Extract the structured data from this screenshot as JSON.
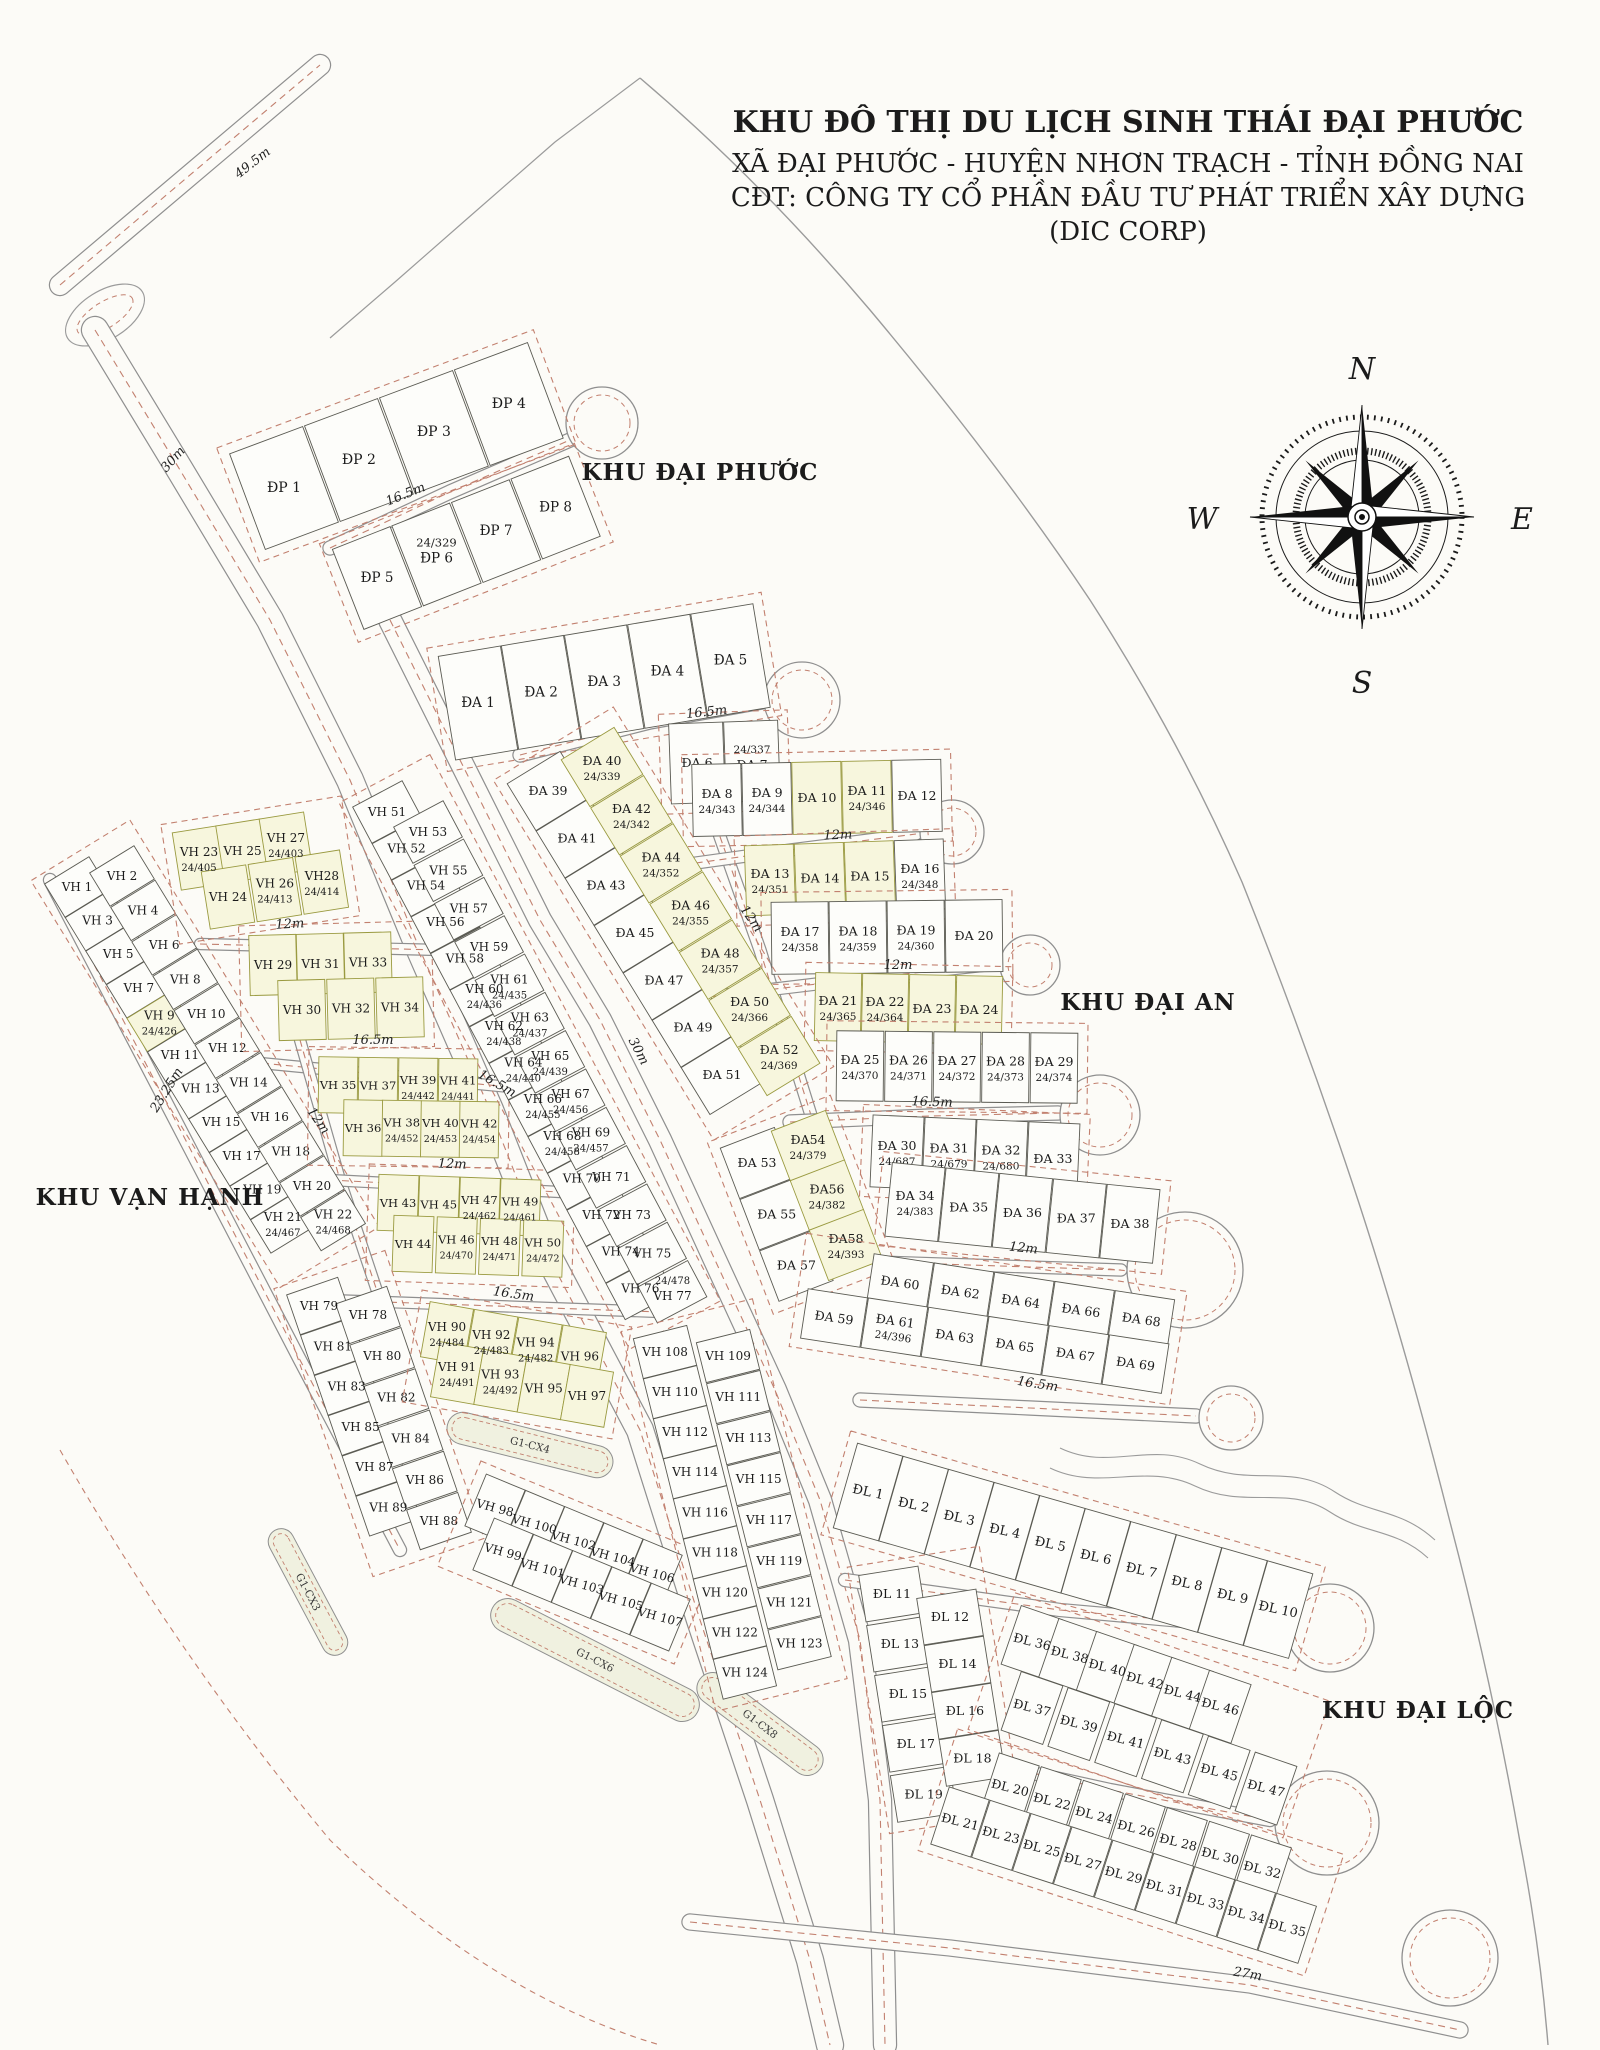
{
  "title": {
    "line1": "KHU ĐÔ THỊ DU LỊCH SINH THÁI ĐẠI PHƯỚC",
    "line2": "XÃ ĐẠI PHƯỚC - HUYỆN NHƠN TRẠCH - TỈNH ĐỒNG NAI",
    "line3": "CĐT: CÔNG TY CỔ PHẦN ĐẦU TƯ PHÁT TRIỂN XÂY DỰNG",
    "line4": "(DIC CORP)"
  },
  "compass": {
    "n": "N",
    "e": "E",
    "s": "S",
    "w": "W"
  },
  "areas": [
    {
      "label": "KHU ĐẠI PHƯỚC"
    },
    {
      "label": "KHU ĐẠI AN"
    },
    {
      "label": "KHU VẠN HẠNH"
    },
    {
      "label": "KHU ĐẠI LỘC"
    }
  ],
  "dimensions": [
    "49.5m",
    "30m",
    "16.5m",
    "16.5m",
    "12m",
    "12m",
    "12m",
    "16.5m",
    "12m",
    "16.5m",
    "12m",
    "16.5m",
    "12m",
    "12m",
    "16.5m",
    "23.25m",
    "30m",
    "16.5m",
    "27m"
  ],
  "greens": [
    "G1-CX3",
    "G1-CX4",
    "G1-CX6",
    "G1-CX8"
  ],
  "colors": {
    "road_dash": "#c2806f",
    "road_edge": "#8f8f8f",
    "lot_fill": "#fdfdfa",
    "lot_tint": "#f7f6dd",
    "paper": "#fcfbf7"
  },
  "blocks": {
    "dp1": {
      "rows": [
        [
          "ĐP 1",
          "ĐP 2",
          "ĐP 3",
          "ĐP 4"
        ]
      ]
    },
    "dp2": {
      "rows": [
        [
          "ĐP 5",
          {
            "n": "ĐP 6",
            "s": "24/329",
            "sa": 1
          },
          "ĐP 7",
          "ĐP 8"
        ]
      ]
    },
    "da1_5": {
      "rows": [
        [
          "ĐA 1",
          "ĐA 2",
          "ĐA 3",
          "ĐA 4",
          "ĐA 5"
        ]
      ]
    },
    "da6_7": {
      "rows": [
        [
          "ĐA 6",
          {
            "n": "ĐA 7",
            "s": "24/337",
            "sa": 1
          }
        ]
      ]
    },
    "da8_12": {
      "rows": [
        [
          {
            "n": "ĐA 8",
            "s": "24/343"
          },
          {
            "n": "ĐA 9",
            "s": "24/344"
          },
          {
            "n": "ĐA 10",
            "t": 1
          },
          {
            "n": "ĐA 11",
            "s": "24/346",
            "t": 1
          },
          "ĐA 12"
        ]
      ]
    },
    "da13_16": {
      "rows": [
        [
          {
            "n": "ĐA 13",
            "s": "24/351",
            "t": 1
          },
          {
            "n": "ĐA 14",
            "t": 1
          },
          {
            "n": "ĐA 15",
            "t": 1
          },
          {
            "n": "ĐA 16",
            "s": "24/348"
          }
        ]
      ]
    },
    "da17_20": {
      "rows": [
        [
          {
            "n": "ĐA 17",
            "s": "24/358"
          },
          {
            "n": "ĐA 18",
            "s": "24/359"
          },
          {
            "n": "ĐA 19",
            "s": "24/360"
          },
          "ĐA 20"
        ]
      ]
    },
    "da21_24": {
      "rows": [
        [
          {
            "n": "ĐA 21",
            "s": "24/365",
            "t": 1
          },
          {
            "n": "ĐA 22",
            "s": "24/364",
            "t": 1
          },
          {
            "n": "ĐA 23",
            "t": 1
          },
          {
            "n": "ĐA 24",
            "t": 1
          }
        ]
      ]
    },
    "da25_29": {
      "rows": [
        [
          {
            "n": "ĐA 25",
            "s": "24/370"
          },
          {
            "n": "ĐA 26",
            "s": "24/371"
          },
          {
            "n": "ĐA 27",
            "s": "24/372"
          },
          {
            "n": "ĐA 28",
            "s": "24/373"
          },
          {
            "n": "ĐA 29",
            "s": "24/374"
          }
        ]
      ]
    },
    "da30_33": {
      "rows": [
        [
          {
            "n": "ĐA 30",
            "s": "24/687"
          },
          {
            "n": "ĐA 31",
            "s": "24/679"
          },
          {
            "n": "ĐA 32",
            "s": "24/680"
          },
          "ĐA 33"
        ]
      ]
    },
    "da34_38": {
      "rows": [
        [
          {
            "n": "ĐA 34",
            "s": "24/383"
          },
          "ĐA 35",
          "ĐA 36",
          "ĐA 37",
          "ĐA 38"
        ]
      ]
    },
    "da39_52": {
      "rows": [
        [
          "ĐA 39",
          "ĐA 41",
          "ĐA 43",
          "ĐA 45",
          "ĐA 47",
          "ĐA 49",
          "ĐA 51"
        ],
        [
          {
            "n": "ĐA 40",
            "s": "24/339",
            "t": 1
          },
          {
            "n": "ĐA 42",
            "s": "24/342",
            "t": 1
          },
          {
            "n": "ĐA 44",
            "s": "24/352",
            "t": 1
          },
          {
            "n": "ĐA 46",
            "s": "24/355",
            "t": 1
          },
          {
            "n": "ĐA 48",
            "s": "24/357",
            "t": 1
          },
          {
            "n": "ĐA 50",
            "s": "24/366",
            "t": 1
          },
          {
            "n": "ĐA 52",
            "s": "24/369",
            "t": 1
          }
        ]
      ]
    },
    "da53_58": {
      "rows": [
        [
          "ĐA 53",
          "ĐA 55",
          "ĐA 57"
        ],
        [
          {
            "n": "ĐA54",
            "s": "24/379",
            "t": 1
          },
          {
            "n": "ĐA56",
            "s": "24/382",
            "t": 1
          },
          {
            "n": "ĐA58",
            "s": "24/393",
            "t": 1
          }
        ]
      ]
    },
    "da59_69": {
      "rows": [
        [
          "ĐA 60",
          "ĐA 62",
          "ĐA 64",
          "ĐA 66",
          "ĐA 68"
        ],
        [
          "ĐA 59",
          {
            "n": "ĐA 61",
            "s": "24/396"
          },
          "ĐA 63",
          "ĐA 65",
          "ĐA 67",
          "ĐA 69"
        ]
      ]
    },
    "vh1_22": {
      "rows": [
        [
          "VH 1",
          "VH 3",
          "VH 5",
          "VH 7",
          {
            "n": "VH 9",
            "s": "24/426",
            "t": 1
          },
          "VH 11",
          "VH 13",
          "VH 15",
          "VH 17",
          "VH 19",
          {
            "n": "VH 21",
            "s": "24/467"
          }
        ],
        [
          "VH 2",
          "VH 4",
          "VH 6",
          "VH 8",
          "VH 10",
          "VH 12",
          "VH 14",
          "VH 16",
          "VH 18",
          "VH 20",
          {
            "n": "VH 22",
            "s": "24/468"
          }
        ]
      ]
    },
    "vh23_28": {
      "rows": [
        [
          {
            "n": "VH 23",
            "s": "24/405",
            "t": 1
          },
          {
            "n": "VH 25",
            "t": 1
          },
          {
            "n": "VH 27",
            "s": "24/403",
            "t": 1
          }
        ],
        [
          {
            "n": "VH 24",
            "t": 1
          },
          {
            "n": "VH 26",
            "s": "24/413",
            "t": 1
          },
          {
            "n": "VH28",
            "s": "24/414",
            "t": 1
          }
        ]
      ]
    },
    "vh29_34": {
      "rows": [
        [
          {
            "n": "VH 29",
            "t": 1
          },
          {
            "n": "VH 31",
            "t": 1
          },
          {
            "n": "VH 33",
            "t": 1
          }
        ],
        [
          {
            "n": "VH 30",
            "t": 1
          },
          {
            "n": "VH 32",
            "t": 1
          },
          {
            "n": "VH 34",
            "t": 1
          }
        ]
      ]
    },
    "vh35_42": {
      "rows": [
        [
          {
            "n": "VH 35",
            "t": 1
          },
          {
            "n": "VH 37",
            "t": 1
          },
          {
            "n": "VH 39",
            "s": "24/442",
            "t": 1
          },
          {
            "n": "VH 41",
            "s": "24/441",
            "t": 1
          }
        ],
        [
          {
            "n": "VH 36",
            "t": 1
          },
          {
            "n": "VH 38",
            "s": "24/452",
            "t": 1
          },
          {
            "n": "VH 40",
            "s": "24/453",
            "t": 1
          },
          {
            "n": "VH 42",
            "s": "24/454",
            "t": 1
          }
        ]
      ]
    },
    "vh43_50": {
      "rows": [
        [
          {
            "n": "VH 43",
            "t": 1
          },
          {
            "n": "VH 45",
            "t": 1
          },
          {
            "n": "VH 47",
            "s": "24/462",
            "t": 1
          },
          {
            "n": "VH 49",
            "s": "24/461",
            "t": 1
          }
        ],
        [
          {
            "n": "VH 44",
            "t": 1
          },
          {
            "n": "VH 46",
            "s": "24/470",
            "t": 1
          },
          {
            "n": "VH 48",
            "s": "24/471",
            "t": 1
          },
          {
            "n": "VH 50",
            "s": "24/472",
            "t": 1
          }
        ]
      ]
    },
    "vh51_77": {
      "rows": [
        [
          "VH 51",
          "VH 52",
          "VH 54",
          "VH 56",
          "VH 58",
          {
            "n": "VH 60",
            "s": "24/436"
          },
          {
            "n": "VH 62",
            "s": "24/438"
          },
          {
            "n": "VH 64",
            "s": "24/440"
          },
          {
            "n": "VH 66",
            "s": "24/455"
          },
          {
            "n": "VH 68",
            "s": "24/458"
          },
          "VH 70",
          "VH 72",
          "VH 74",
          "VH 76"
        ],
        [
          "VH 53",
          "VH 55",
          "VH 57",
          "VH 59",
          {
            "n": "VH 61",
            "s": "24/435"
          },
          {
            "n": "VH 63",
            "s": "24/437"
          },
          {
            "n": "VH 65",
            "s": "24/439"
          },
          {
            "n": "VH 67",
            "s": "24/456"
          },
          {
            "n": "VH 69",
            "s": "24/457"
          },
          "VH 71",
          "VH 73",
          "VH 75",
          {
            "n": "VH 77",
            "s": "24/478",
            "sa": 1
          }
        ]
      ]
    },
    "vh78_89": {
      "rows": [
        [
          "VH 79",
          "VH 81",
          "VH 83",
          "VH 85",
          "VH 87",
          "VH 89"
        ],
        [
          "VH 78",
          "VH 80",
          "VH 82",
          "VH 84",
          "VH 86",
          "VH 88"
        ]
      ]
    },
    "vh90_97": {
      "rows": [
        [
          {
            "n": "VH 90",
            "s": "24/484",
            "t": 1
          },
          {
            "n": "VH 92",
            "s": "24/483",
            "t": 1
          },
          {
            "n": "VH 94",
            "s": "24/482",
            "t": 1
          },
          {
            "n": "VH 96",
            "t": 1
          }
        ],
        [
          {
            "n": "VH 91",
            "s": "24/491",
            "t": 1
          },
          {
            "n": "VH 93",
            "s": "24/492",
            "t": 1
          },
          {
            "n": "VH 95",
            "t": 1
          },
          {
            "n": "VH 97",
            "t": 1
          }
        ]
      ]
    },
    "vh98_107": {
      "rows": [
        [
          "VH 98",
          "VH 100",
          "VH 102",
          "VH 104",
          "VH 106"
        ],
        [
          "VH 99",
          "VH 101",
          "VH 103",
          "VH 105",
          "VH 107"
        ]
      ]
    },
    "vh108_124": {
      "rows": [
        [
          "VH 108",
          "VH 110",
          "VH 112",
          "VH 114",
          "VH 116",
          "VH 118",
          "VH 120",
          "VH 122",
          "VH 124"
        ],
        [
          "VH 109",
          "VH 111",
          "VH 113",
          "VH 115",
          "VH 117",
          "VH 119",
          "VH 121",
          "VH 123"
        ]
      ]
    },
    "dl1_10": {
      "rows": [
        [
          "ĐL 1",
          "ĐL 2",
          "ĐL 3",
          "ĐL 4",
          "ĐL 5",
          "ĐL 6",
          "ĐL 7",
          "ĐL 8",
          "ĐL 9",
          "ĐL 10"
        ]
      ]
    },
    "dl11_19": {
      "rows": [
        [
          "ĐL 11",
          "ĐL 13",
          "ĐL 15",
          "ĐL 17",
          "ĐL 19"
        ],
        [
          "ĐL 12",
          "ĐL 14",
          "ĐL 16",
          "ĐL 18"
        ]
      ]
    },
    "dl36_47": {
      "rows": [
        [
          "ĐL 36",
          "ĐL 38",
          "ĐL 40",
          "ĐL 42",
          "ĐL 44",
          "ĐL 46"
        ],
        [
          "ĐL 37",
          "ĐL 39",
          "ĐL 41",
          "ĐL 43",
          "ĐL 45",
          "ĐL 47"
        ]
      ]
    },
    "dl20_35": {
      "rows": [
        [
          "ĐL 20",
          "ĐL 22",
          "ĐL 24",
          "ĐL 26",
          "ĐL 28",
          "ĐL 30",
          "ĐL 32"
        ],
        [
          "ĐL 21",
          "ĐL 23",
          "ĐL 25",
          "ĐL 27",
          "ĐL 29",
          "ĐL 31",
          "ĐL 33",
          "ĐL 34",
          "ĐL 35"
        ]
      ]
    }
  }
}
